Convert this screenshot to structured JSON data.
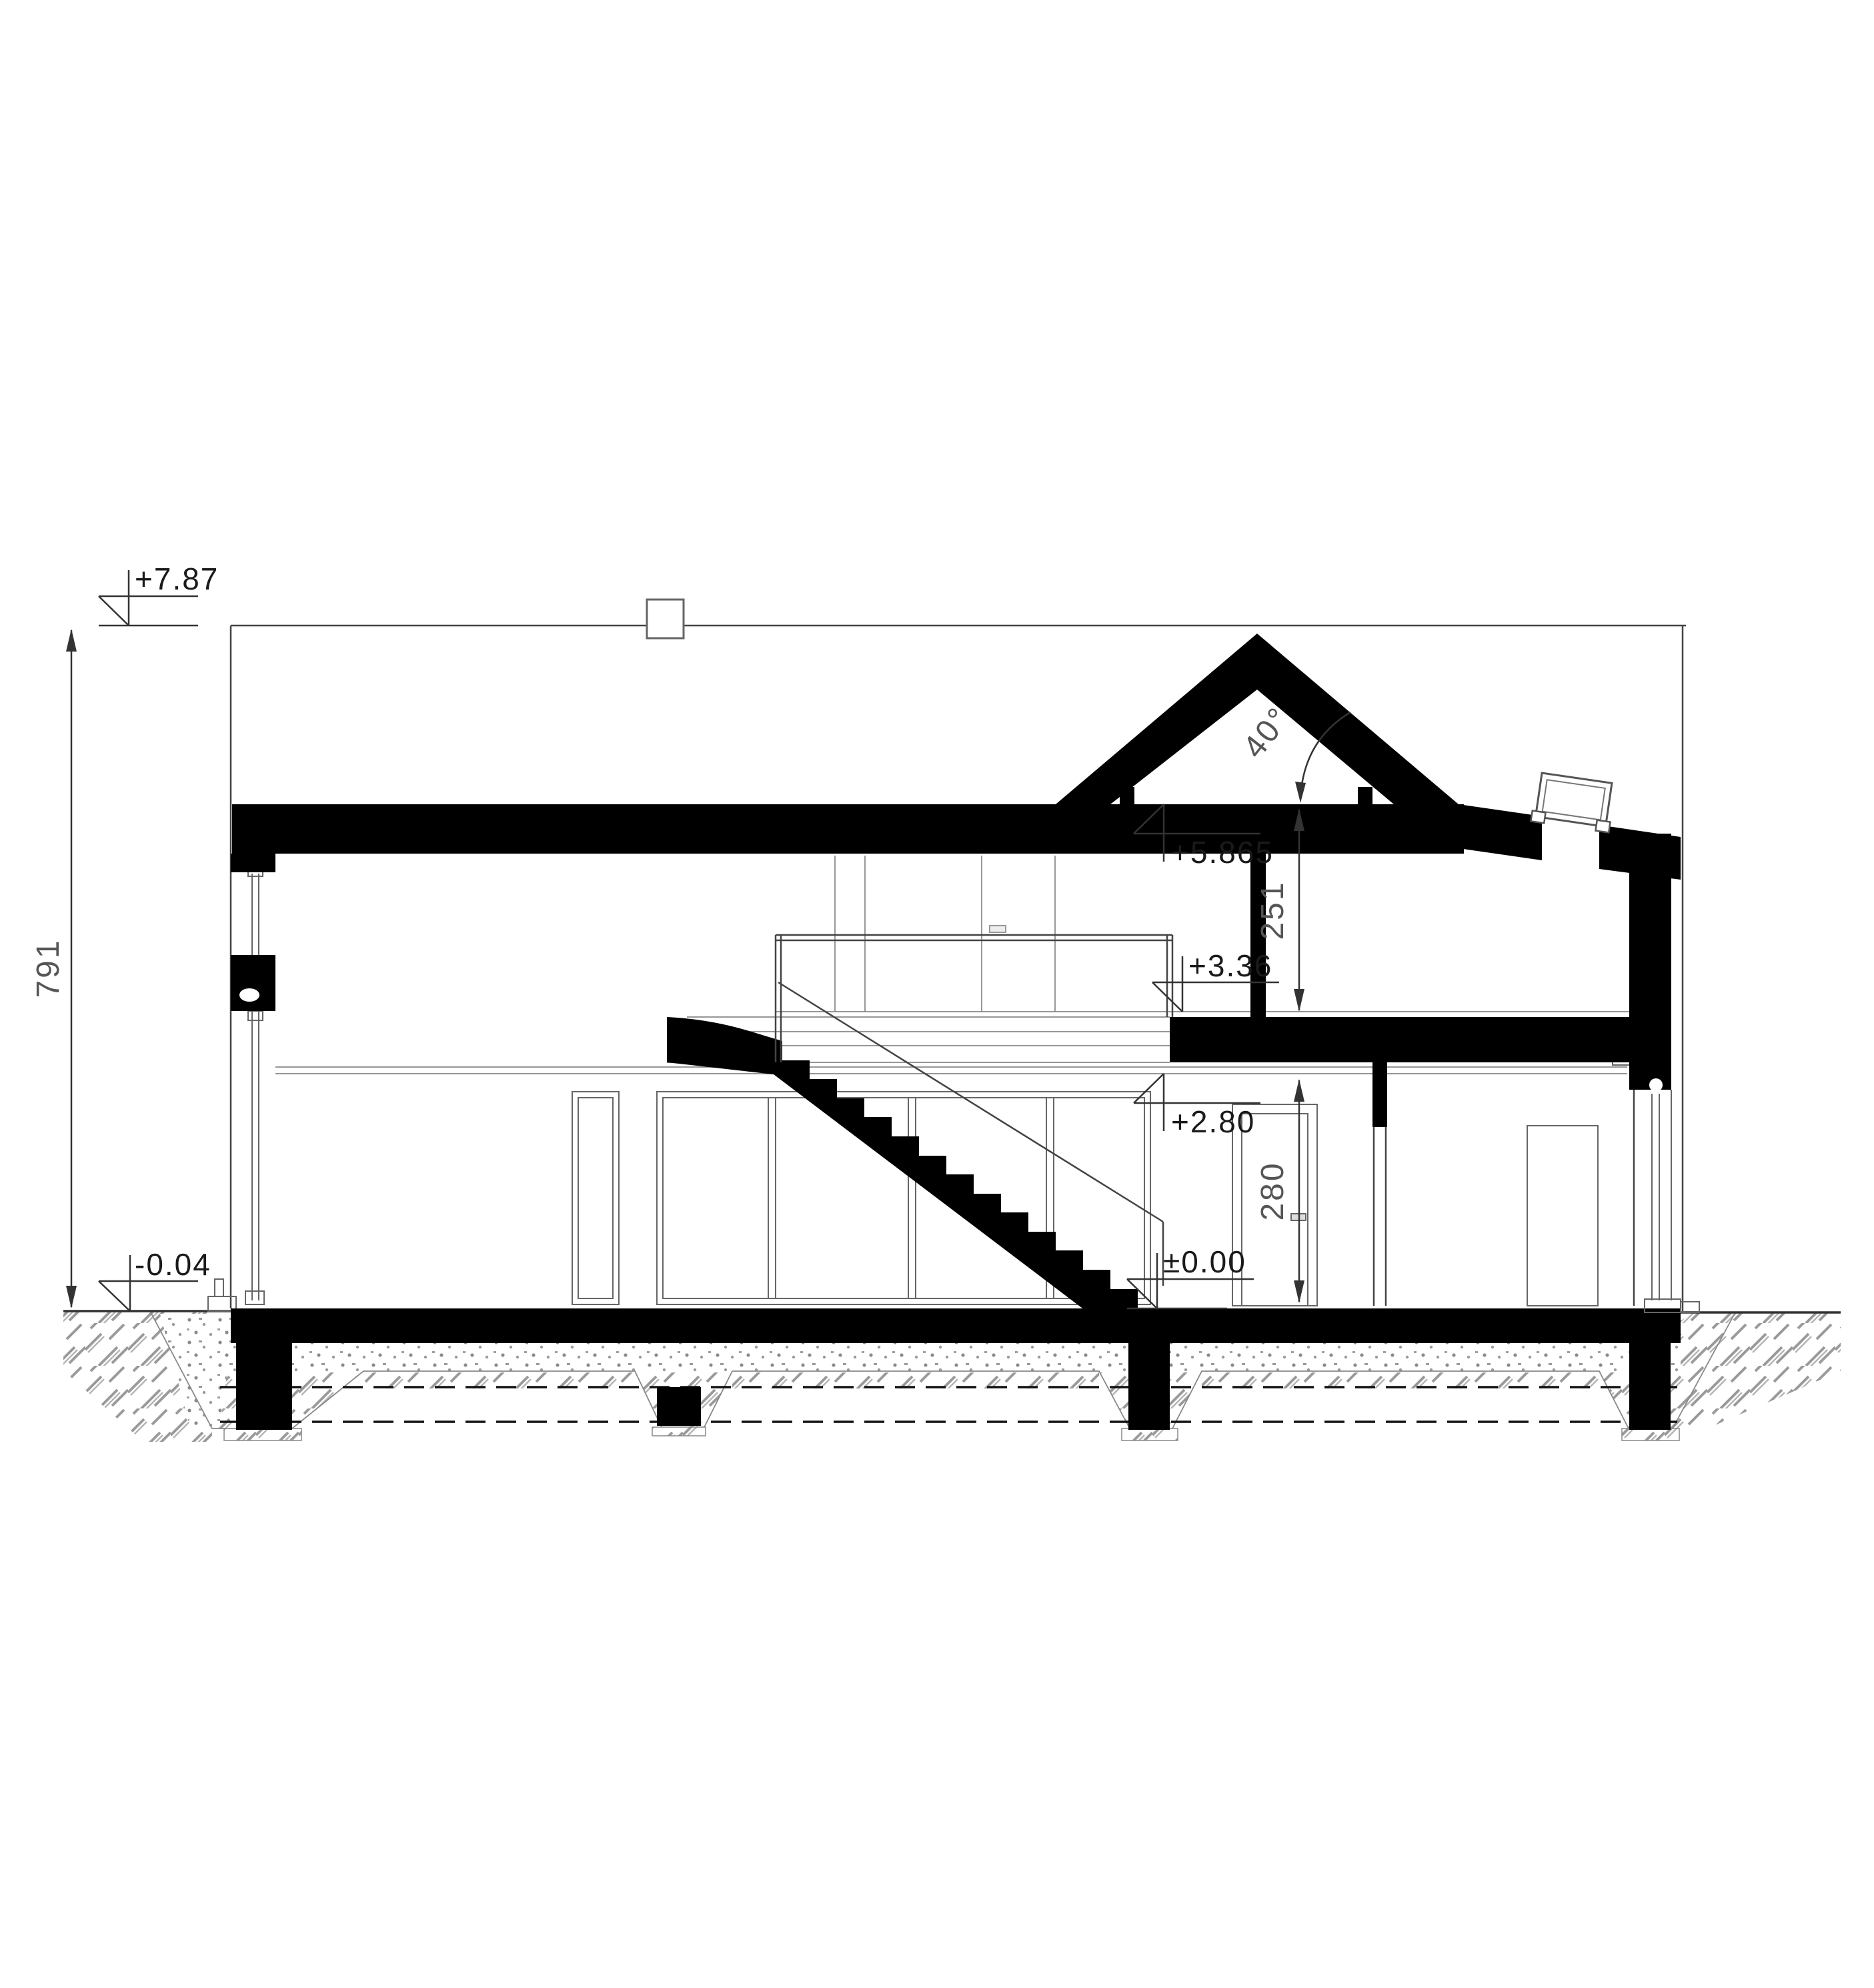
{
  "drawing": {
    "title": "house-cross-section",
    "levels": {
      "ridge": "+7.87",
      "ground_outside": "-0.04",
      "attic_ceiling": "+5.865",
      "attic_floor": "+3.36",
      "gf_ceiling": "+2.80",
      "gf_floor": "±0.00"
    },
    "dimensions": {
      "total_height_cm": "791",
      "attic_room_height_cm": "251",
      "gf_room_height_cm": "280",
      "roof_angle": "40°"
    },
    "colors": {
      "section_cut": "#000000",
      "outline": "#444444",
      "background": "#ffffff"
    }
  }
}
